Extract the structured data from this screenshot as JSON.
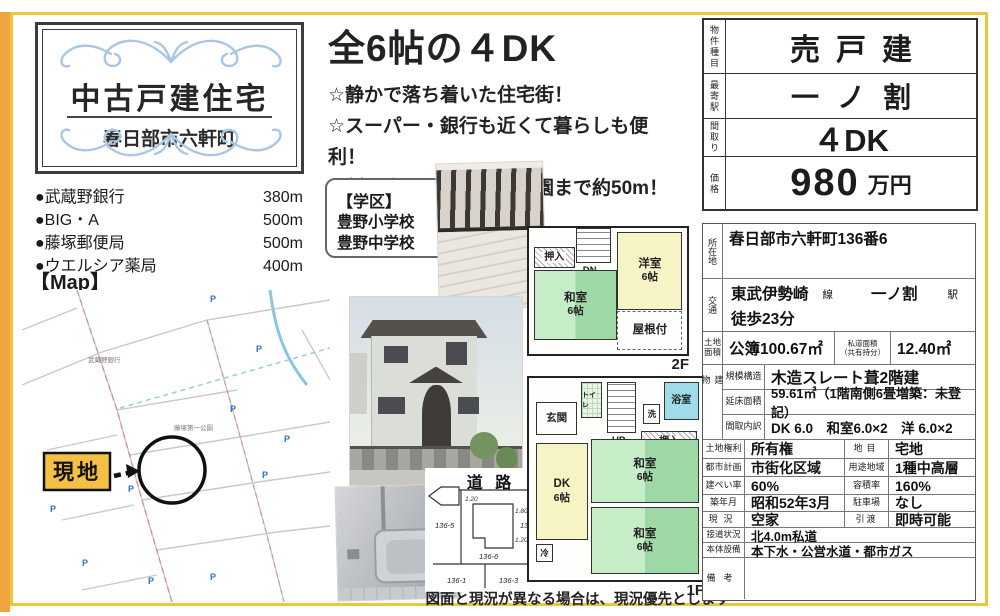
{
  "page": {
    "note": "図面と現況が異なる場合は、現況優先とします"
  },
  "title_box": {
    "title": "中古戸建住宅",
    "subtitle": "春日部市六軒町"
  },
  "headline": {
    "title": "全6帖の４DK",
    "points": [
      "☆静かで落ち着いた住宅街！",
      "☆スーパー・銀行も近くて暮らしも便利！",
      "☆割と広めな藤塚第一公園まで約50m！"
    ]
  },
  "facilities": {
    "items": [
      {
        "name": "●武蔵野銀行",
        "distance": "380m"
      },
      {
        "name": "●BIG・A",
        "distance": "500m"
      },
      {
        "name": "●藤塚郵便局",
        "distance": "500m"
      },
      {
        "name": "●ウエルシア薬局",
        "distance": "400m"
      }
    ]
  },
  "map": {
    "heading": "【Map】",
    "site_label": "現地",
    "parking_glyph": "P",
    "labels": {
      "bank": "武蔵野銀行",
      "park": "藤塚第一公園"
    }
  },
  "school": {
    "heading": "【学区】",
    "line1": "豊野小学校",
    "line2": "豊野中学校"
  },
  "summary": {
    "type_label": "物件種目",
    "type_value": "売戸建",
    "station_label": "最寄駅",
    "station_value": "一ノ割",
    "layout_label": "間取り",
    "layout_value": "４DK",
    "price_label": "価格",
    "price_value": "980",
    "price_unit": "万円"
  },
  "details": {
    "location_label": "所在地",
    "location": "春日部市六軒町136番6",
    "access_label": "交通",
    "access_line_value": "東武伊勢崎",
    "access_line_suffix": "線",
    "access_station_value": "一ノ割",
    "access_station_suffix": "駅",
    "access_walk": "徒歩23分",
    "land_area_label": "土地面積",
    "land_area": "公簿100.67㎡",
    "private_road_label1": "私道面積",
    "private_road_label2": "（共有持分）",
    "private_road": "12.40㎡",
    "building_label": "建物",
    "structure_label": "規模構造",
    "structure": "木造スレート葺2階建",
    "floor_area_label": "延床面積",
    "floor_area": "59.61㎡（1階南側6畳増築：未登記）",
    "layout_label": "間取内訳",
    "layout": "DK 6.0　和室6.0×2　洋 6.0×2",
    "land_right_label": "土地権利",
    "land_right": "所有権",
    "land_cat_label": "地目",
    "land_cat": "宅地",
    "city_plan_label": "都市計画",
    "city_plan": "市街化区域",
    "zoning_label": "用途地域",
    "zoning": "1種中高層",
    "coverage_label": "建ぺい率",
    "coverage": "60%",
    "far_label": "容積率",
    "far": "160%",
    "built_label": "築年月",
    "built": "昭和52年3月",
    "parking_label": "駐車場",
    "parking": "なし",
    "status_label": "現況",
    "status": "空家",
    "handover_label": "引渡",
    "handover": "即時可能",
    "road_label": "接道状況",
    "road": "北4.0m私道",
    "utilities_label": "本体設備",
    "utilities": "本下水・公営水道・都市ガス",
    "remarks_label": "備考",
    "remarks": ""
  },
  "floorplan_2f": {
    "closet": "押入",
    "stairs": "DN",
    "western": "洋室",
    "western_size": "6帖",
    "japanese": "和室",
    "japanese_size": "6帖",
    "roof": "屋根付",
    "floor": "2F"
  },
  "floorplan_1f": {
    "entrance": "玄関",
    "toilet": "トイレ",
    "stairs": "UP",
    "laundry": "洗",
    "bath": "浴室",
    "closet": "押入",
    "dk": "DK",
    "dk_size": "6帖",
    "jp1": "和室",
    "jp1_size": "6帖",
    "jp2": "和室",
    "jp2_size": "6帖",
    "fridge": "冷",
    "floor": "1F"
  },
  "lot": {
    "road": "道 路",
    "m1": "1.20",
    "m2": "1.80",
    "m3": "1.20",
    "lot_left": "136-5",
    "lot_right": "136-7",
    "lot_center": "136-6",
    "lot_bl": "136-1",
    "lot_br": "136-3"
  },
  "colors": {
    "frame_yellow": "#ecc63c",
    "edge_orange": "#eea43f",
    "tatami_green": "#9ed8a6",
    "room_yellow": "#f6f3c4",
    "bath_blue": "#9fdce9",
    "flourish_blue": "#a9c6e5",
    "site_box": "#f3bf45"
  }
}
